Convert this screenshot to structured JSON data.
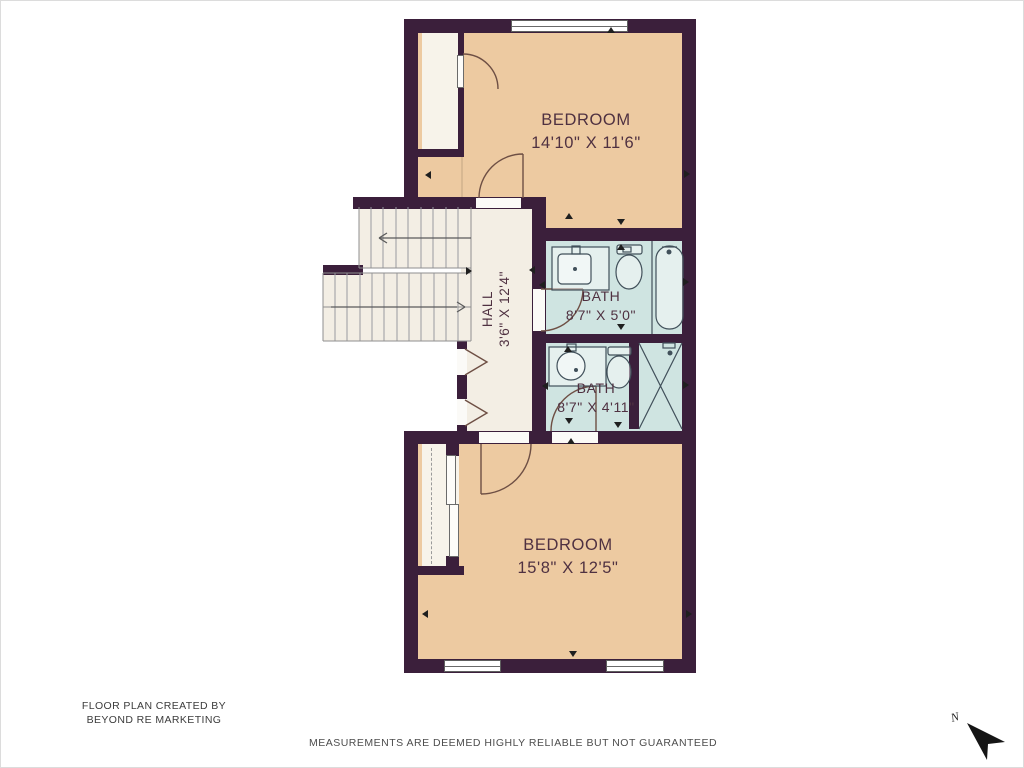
{
  "colors": {
    "wall": "#3b1f3b",
    "bedroom": "#edcaa1",
    "hall": "#f3eee4",
    "bath": "#cfe4e1",
    "closet": "#f7f3ea",
    "door_line": "#6e4f44",
    "fixture_line": "#41505a",
    "tread_line": "#9a9aa0",
    "label_text": "#4f3141",
    "footer_text": "#3c3c3c",
    "background": "#ffffff"
  },
  "rooms": [
    {
      "name": "BEDROOM",
      "dims": "14'10\" X 11'6\""
    },
    {
      "name": "HALL",
      "dims": "3'6\" X 12'4\""
    },
    {
      "name": "BATH",
      "dims": "8'7\" X 5'0\""
    },
    {
      "name": "BATH",
      "dims": "8'7\" X 4'11\""
    },
    {
      "name": "BEDROOM",
      "dims": "15'8\" X 12'5\""
    }
  ],
  "footer": {
    "credit_line1": "FLOOR PLAN CREATED BY",
    "credit_line2": "BEYOND RE MARKETING",
    "disclaimer": "MEASUREMENTS ARE DEEMED HIGHLY RELIABLE BUT NOT GUARANTEED"
  },
  "compass": {
    "label": "N"
  }
}
